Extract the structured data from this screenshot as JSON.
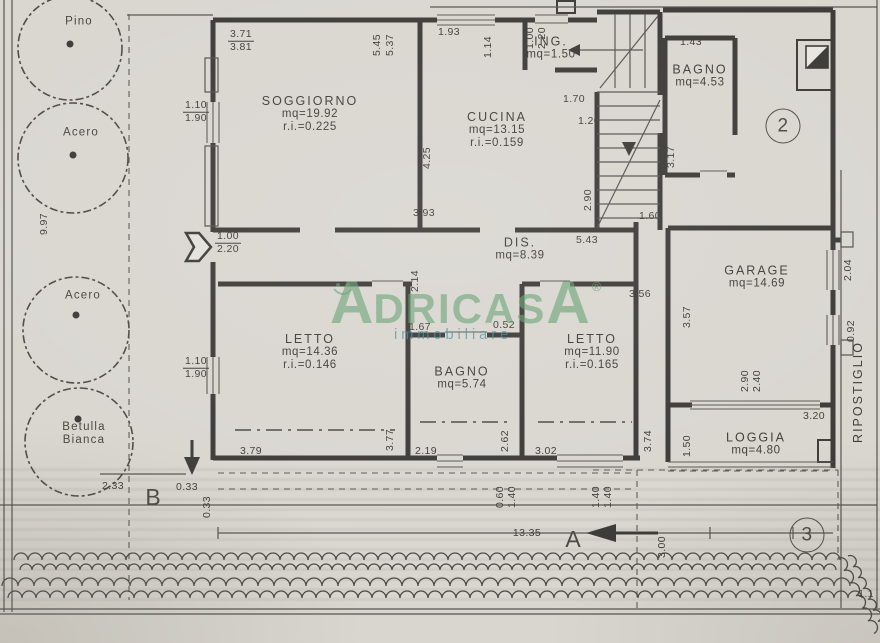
{
  "meta": {
    "paper_color": "#d9d6d0",
    "line_color": "#3a3936",
    "watermark_green": "#629e70",
    "watermark_teal": "#3e8c9e"
  },
  "watermark": {
    "brand_start": "A",
    "brand_mid": "DRICAS",
    "brand_end": "A",
    "reg": "®",
    "sub": "immobiliare"
  },
  "trees": [
    {
      "lines": [
        "Pino"
      ],
      "x": 79,
      "y": 22
    },
    {
      "lines": [
        "Acero"
      ],
      "x": 81,
      "y": 133
    },
    {
      "lines": [
        "Acero"
      ],
      "x": 83,
      "y": 296
    },
    {
      "lines": [
        "Betulla",
        "Bianca"
      ],
      "x": 84,
      "y": 434
    }
  ],
  "rooms": [
    {
      "lines": [
        "SOGGIORNO",
        "mq=19.92",
        "r.i.=0.225"
      ],
      "x": 310,
      "y": 114
    },
    {
      "lines": [
        "CUCINA",
        "mq=13.15",
        "r.i.=0.159"
      ],
      "x": 497,
      "y": 130
    },
    {
      "lines": [
        "ING.",
        "mq=1.50"
      ],
      "x": 551,
      "y": 48
    },
    {
      "lines": [
        "BAGNO",
        "mq=4.53"
      ],
      "x": 700,
      "y": 76
    },
    {
      "lines": [
        "DIS.",
        "mq=8.39"
      ],
      "x": 520,
      "y": 249
    },
    {
      "lines": [
        "GARAGE",
        "mq=14.69"
      ],
      "x": 757,
      "y": 277
    },
    {
      "lines": [
        "LETTO",
        "mq=14.36",
        "r.i.=0.146"
      ],
      "x": 310,
      "y": 352
    },
    {
      "lines": [
        "BAGNO",
        "mq=5.74"
      ],
      "x": 462,
      "y": 378
    },
    {
      "lines": [
        "LETTO",
        "mq=11.90",
        "r.i.=0.165"
      ],
      "x": 592,
      "y": 352
    },
    {
      "lines": [
        "LOGGIA",
        "mq=4.80"
      ],
      "x": 756,
      "y": 444
    },
    {
      "lines": [
        "RIPOSTIGLIO"
      ],
      "x": 858,
      "y": 392,
      "rot": -90
    }
  ],
  "dims": [
    {
      "t": "1.93",
      "x": 449,
      "y": 33
    },
    {
      "t": "5.45",
      "x": 378,
      "y": 45,
      "rot": -90
    },
    {
      "t": "5.37",
      "x": 391,
      "y": 45,
      "rot": -90
    },
    {
      "t": "1.14",
      "x": 489,
      "y": 47,
      "rot": -90
    },
    {
      "t": "1.00",
      "x": 531,
      "y": 38,
      "rot": -90
    },
    {
      "t": "2.20",
      "x": 543,
      "y": 38,
      "rot": -90
    },
    {
      "t": "1.43",
      "x": 691,
      "y": 43
    },
    {
      "t": "1.70",
      "x": 574,
      "y": 100
    },
    {
      "t": "1.20",
      "x": 589,
      "y": 122
    },
    {
      "t": "3.17",
      "x": 672,
      "y": 157,
      "rot": -90
    },
    {
      "t": "4.25",
      "x": 428,
      "y": 158,
      "rot": -90
    },
    {
      "t": "3.93",
      "x": 424,
      "y": 214
    },
    {
      "t": "2.90",
      "x": 589,
      "y": 200,
      "rot": -90
    },
    {
      "t": "5.43",
      "x": 587,
      "y": 241
    },
    {
      "t": "1.60",
      "x": 650,
      "y": 217
    },
    {
      "t": "2.14",
      "x": 416,
      "y": 281,
      "rot": -90
    },
    {
      "t": "3.56",
      "x": 640,
      "y": 295
    },
    {
      "t": "3.57",
      "x": 688,
      "y": 317,
      "rot": -90
    },
    {
      "t": "1.67",
      "x": 420,
      "y": 328
    },
    {
      "t": "0.52",
      "x": 504,
      "y": 326
    },
    {
      "t": "9.97",
      "x": 45,
      "y": 224,
      "rot": -90
    },
    {
      "t": "2.04",
      "x": 849,
      "y": 270,
      "rot": -90
    },
    {
      "t": "0.92",
      "x": 852,
      "y": 331,
      "rot": -90
    },
    {
      "t": "2.90",
      "x": 746,
      "y": 381,
      "rot": -90
    },
    {
      "t": "2.40",
      "x": 758,
      "y": 381,
      "rot": -90
    },
    {
      "t": "3.20",
      "x": 814,
      "y": 417
    },
    {
      "t": "3.74",
      "x": 649,
      "y": 441,
      "rot": -90
    },
    {
      "t": "1.50",
      "x": 688,
      "y": 446,
      "rot": -90
    },
    {
      "t": "3.79",
      "x": 251,
      "y": 452
    },
    {
      "t": "3.77",
      "x": 391,
      "y": 440,
      "rot": -90
    },
    {
      "t": "2.19",
      "x": 426,
      "y": 452
    },
    {
      "t": "2.62",
      "x": 506,
      "y": 441,
      "rot": -90
    },
    {
      "t": "3.02",
      "x": 546,
      "y": 452
    },
    {
      "t": "0.60",
      "x": 501,
      "y": 497,
      "rot": -90
    },
    {
      "t": "1.40",
      "x": 513,
      "y": 497,
      "rot": -90
    },
    {
      "t": "1.40",
      "x": 597,
      "y": 497,
      "rot": -90
    },
    {
      "t": "1.40",
      "x": 609,
      "y": 497,
      "rot": -90
    },
    {
      "t": "2.33",
      "x": 113,
      "y": 487
    },
    {
      "t": "0.33",
      "x": 187,
      "y": 488
    },
    {
      "t": "0.33",
      "x": 208,
      "y": 507,
      "rot": -90
    },
    {
      "t": "13.35",
      "x": 527,
      "y": 534
    },
    {
      "t": "3.00",
      "x": 663,
      "y": 547,
      "rot": -90
    },
    {
      "t": "1.1",
      "x": 866,
      "y": 595
    }
  ],
  "fractions": [
    {
      "top": "3.71",
      "bottom": "3.81",
      "x": 241,
      "y": 41
    },
    {
      "top": "1.10",
      "bottom": "1.90",
      "x": 196,
      "y": 112
    },
    {
      "top": "1.00",
      "bottom": "2.20",
      "x": 228,
      "y": 243
    },
    {
      "top": "1.10",
      "bottom": "1.90",
      "x": 196,
      "y": 368
    }
  ],
  "markers": [
    {
      "t": "B",
      "x": 153,
      "y": 498,
      "kind": "plain"
    },
    {
      "t": "A",
      "x": 573,
      "y": 540,
      "kind": "plain"
    },
    {
      "t": "2",
      "x": 783,
      "y": 126,
      "kind": "circle"
    },
    {
      "t": "3",
      "x": 807,
      "y": 535,
      "kind": "circle"
    }
  ]
}
